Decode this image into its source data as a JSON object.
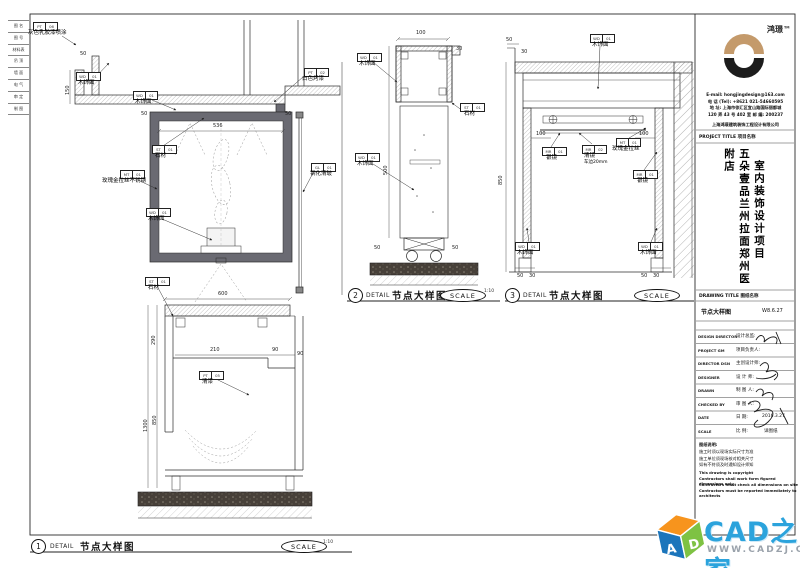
{
  "colors": {
    "tan": "#c49a6b",
    "logo_black": "#1c1c1c",
    "frame_gray": "#6a6a72",
    "wm_blue": "#2ba3dc",
    "wm_gray": "#9aa2ab",
    "cube_orange": "#f7941d",
    "cube_blue": "#1b75bb",
    "cube_green": "#7ec243"
  },
  "sheet": {
    "legend_rows": [
      "图 名",
      "图 号",
      "材料表",
      "吊 顶",
      "墙 面",
      "电 气",
      "审 定",
      "制 图"
    ]
  },
  "captions": [
    {
      "num": "1",
      "detail": "DETAIL",
      "title": "节点大样图",
      "scale_label": "SCALE",
      "ratio": "1:10"
    },
    {
      "num": "2",
      "detail": "DETAIL",
      "title": "节点大样图",
      "scale_label": "SCALE",
      "ratio": "1:10"
    },
    {
      "num": "3",
      "detail": "DETAIL",
      "title": "节点大样图",
      "scale_label": "SCALE",
      "ratio": ""
    }
  ],
  "d1": {
    "labels": [
      {
        "c1": "PT",
        "c2": "06",
        "t": "灰色乳胶漆喷涂"
      },
      {
        "c1": "WD",
        "c2": "01",
        "t": "木饰面"
      },
      {
        "c1": "WD",
        "c2": "01",
        "t": "木饰面"
      },
      {
        "c1": "PT",
        "c2": "02",
        "t": "白色烤漆"
      },
      {
        "c1": "ST",
        "c2": "01",
        "t": "石材"
      },
      {
        "c1": "MT",
        "c2": "01",
        "t": "玫瑰金拉丝不锈钢"
      },
      {
        "c1": "WD",
        "c2": "01",
        "t": "木饰面"
      },
      {
        "c1": "GL",
        "c2": "01",
        "t": "钢化清玻"
      },
      {
        "c1": "ST",
        "c2": "01",
        "t": "石材"
      },
      {
        "c1": "PT",
        "c2": "05",
        "t": "清漆"
      }
    ],
    "dims": [
      "50",
      "536",
      "50",
      "600",
      "290",
      "210",
      "90",
      "850",
      "1300",
      "90",
      "50",
      "150"
    ]
  },
  "d2": {
    "labels": [
      {
        "c1": "WD",
        "c2": "01",
        "t": "木饰面"
      },
      {
        "c1": "ST",
        "c2": "01",
        "t": "石材"
      },
      {
        "c1": "WD",
        "c2": "01",
        "t": "木饰面"
      }
    ],
    "dims": [
      "100",
      "30",
      "500",
      "50",
      "50"
    ]
  },
  "d3": {
    "labels": [
      {
        "c1": "WD",
        "c2": "01",
        "t": "木饰面"
      },
      {
        "c1": "MR",
        "c2": "01",
        "t": "银镜"
      },
      {
        "c1": "MR",
        "c2": "02",
        "t": "清镜",
        "t2": "车边20mm"
      },
      {
        "c1": "MT",
        "c2": "01",
        "t": "玫瑰金拉丝"
      },
      {
        "c1": "MR",
        "c2": "01",
        "t": "银镜"
      },
      {
        "c1": "WD",
        "c2": "01",
        "t": "木饰面"
      },
      {
        "c1": "WD",
        "c2": "01",
        "t": "木饰面"
      }
    ],
    "dims": [
      "50",
      "30",
      "100",
      "100",
      "850",
      "50",
      "30",
      "50",
      "30"
    ]
  },
  "titleblock": {
    "brand": "鸿璟™",
    "contact": [
      "E-mail: hongjingdesign@163.com",
      "电 话 (Tel): +8621 021-54660595",
      "地 址: 上海市徐汇区宜山路国际丽都城",
      "120 弄 43 号 402 室  邮 编: 200237"
    ],
    "company": "上海鸿璟建筑装饰工程设计有限公司",
    "project_title_label": "PROJECT TITLE 项目名称",
    "project_name": "五朵壹品兰州拉面郑州医附店",
    "project_type": "室内装饰设计项目",
    "drawing_title_label": "DRAWING TITLE 图纸名称",
    "drawing_title": "节点大样图",
    "drawing_no": "W8.6.27",
    "rows": [
      {
        "en": "DESIGN DIRECTOR",
        "cn": "设计总监:"
      },
      {
        "en": "PROJECT GM",
        "cn": "项目负责人:"
      },
      {
        "en": "DIRECTOR DSN",
        "cn": "主创设计师:"
      },
      {
        "en": "DESIGNER",
        "cn": "设 计 师:"
      },
      {
        "en": "DRAWN",
        "cn": "制 图 人:"
      },
      {
        "en": "CHECKED BY",
        "cn": "审 图 人:"
      },
      {
        "en": "DATE",
        "cn": "日 期:",
        "val": "2016.3.27"
      },
      {
        "en": "SCALE",
        "cn": "比 例:",
        "val": "详图纸"
      }
    ],
    "notes_heading": "图纸说明:",
    "notes_cn": [
      "施工时须以现场实际尺寸为准",
      "施工单位须现场核对相关尺寸",
      "如有不符须及时通知设计师知"
    ],
    "notes_en": [
      "This drawing is copyright",
      "Contractors shall work form figured dimensions only",
      "Contractors must check all dimensions on site",
      "Contractors must be reported immediately to architects"
    ]
  },
  "watermark": {
    "name": "CAD之家",
    "url": "WWW.CADZJ.COM",
    "cube_a": "A",
    "cube_d": "D"
  }
}
